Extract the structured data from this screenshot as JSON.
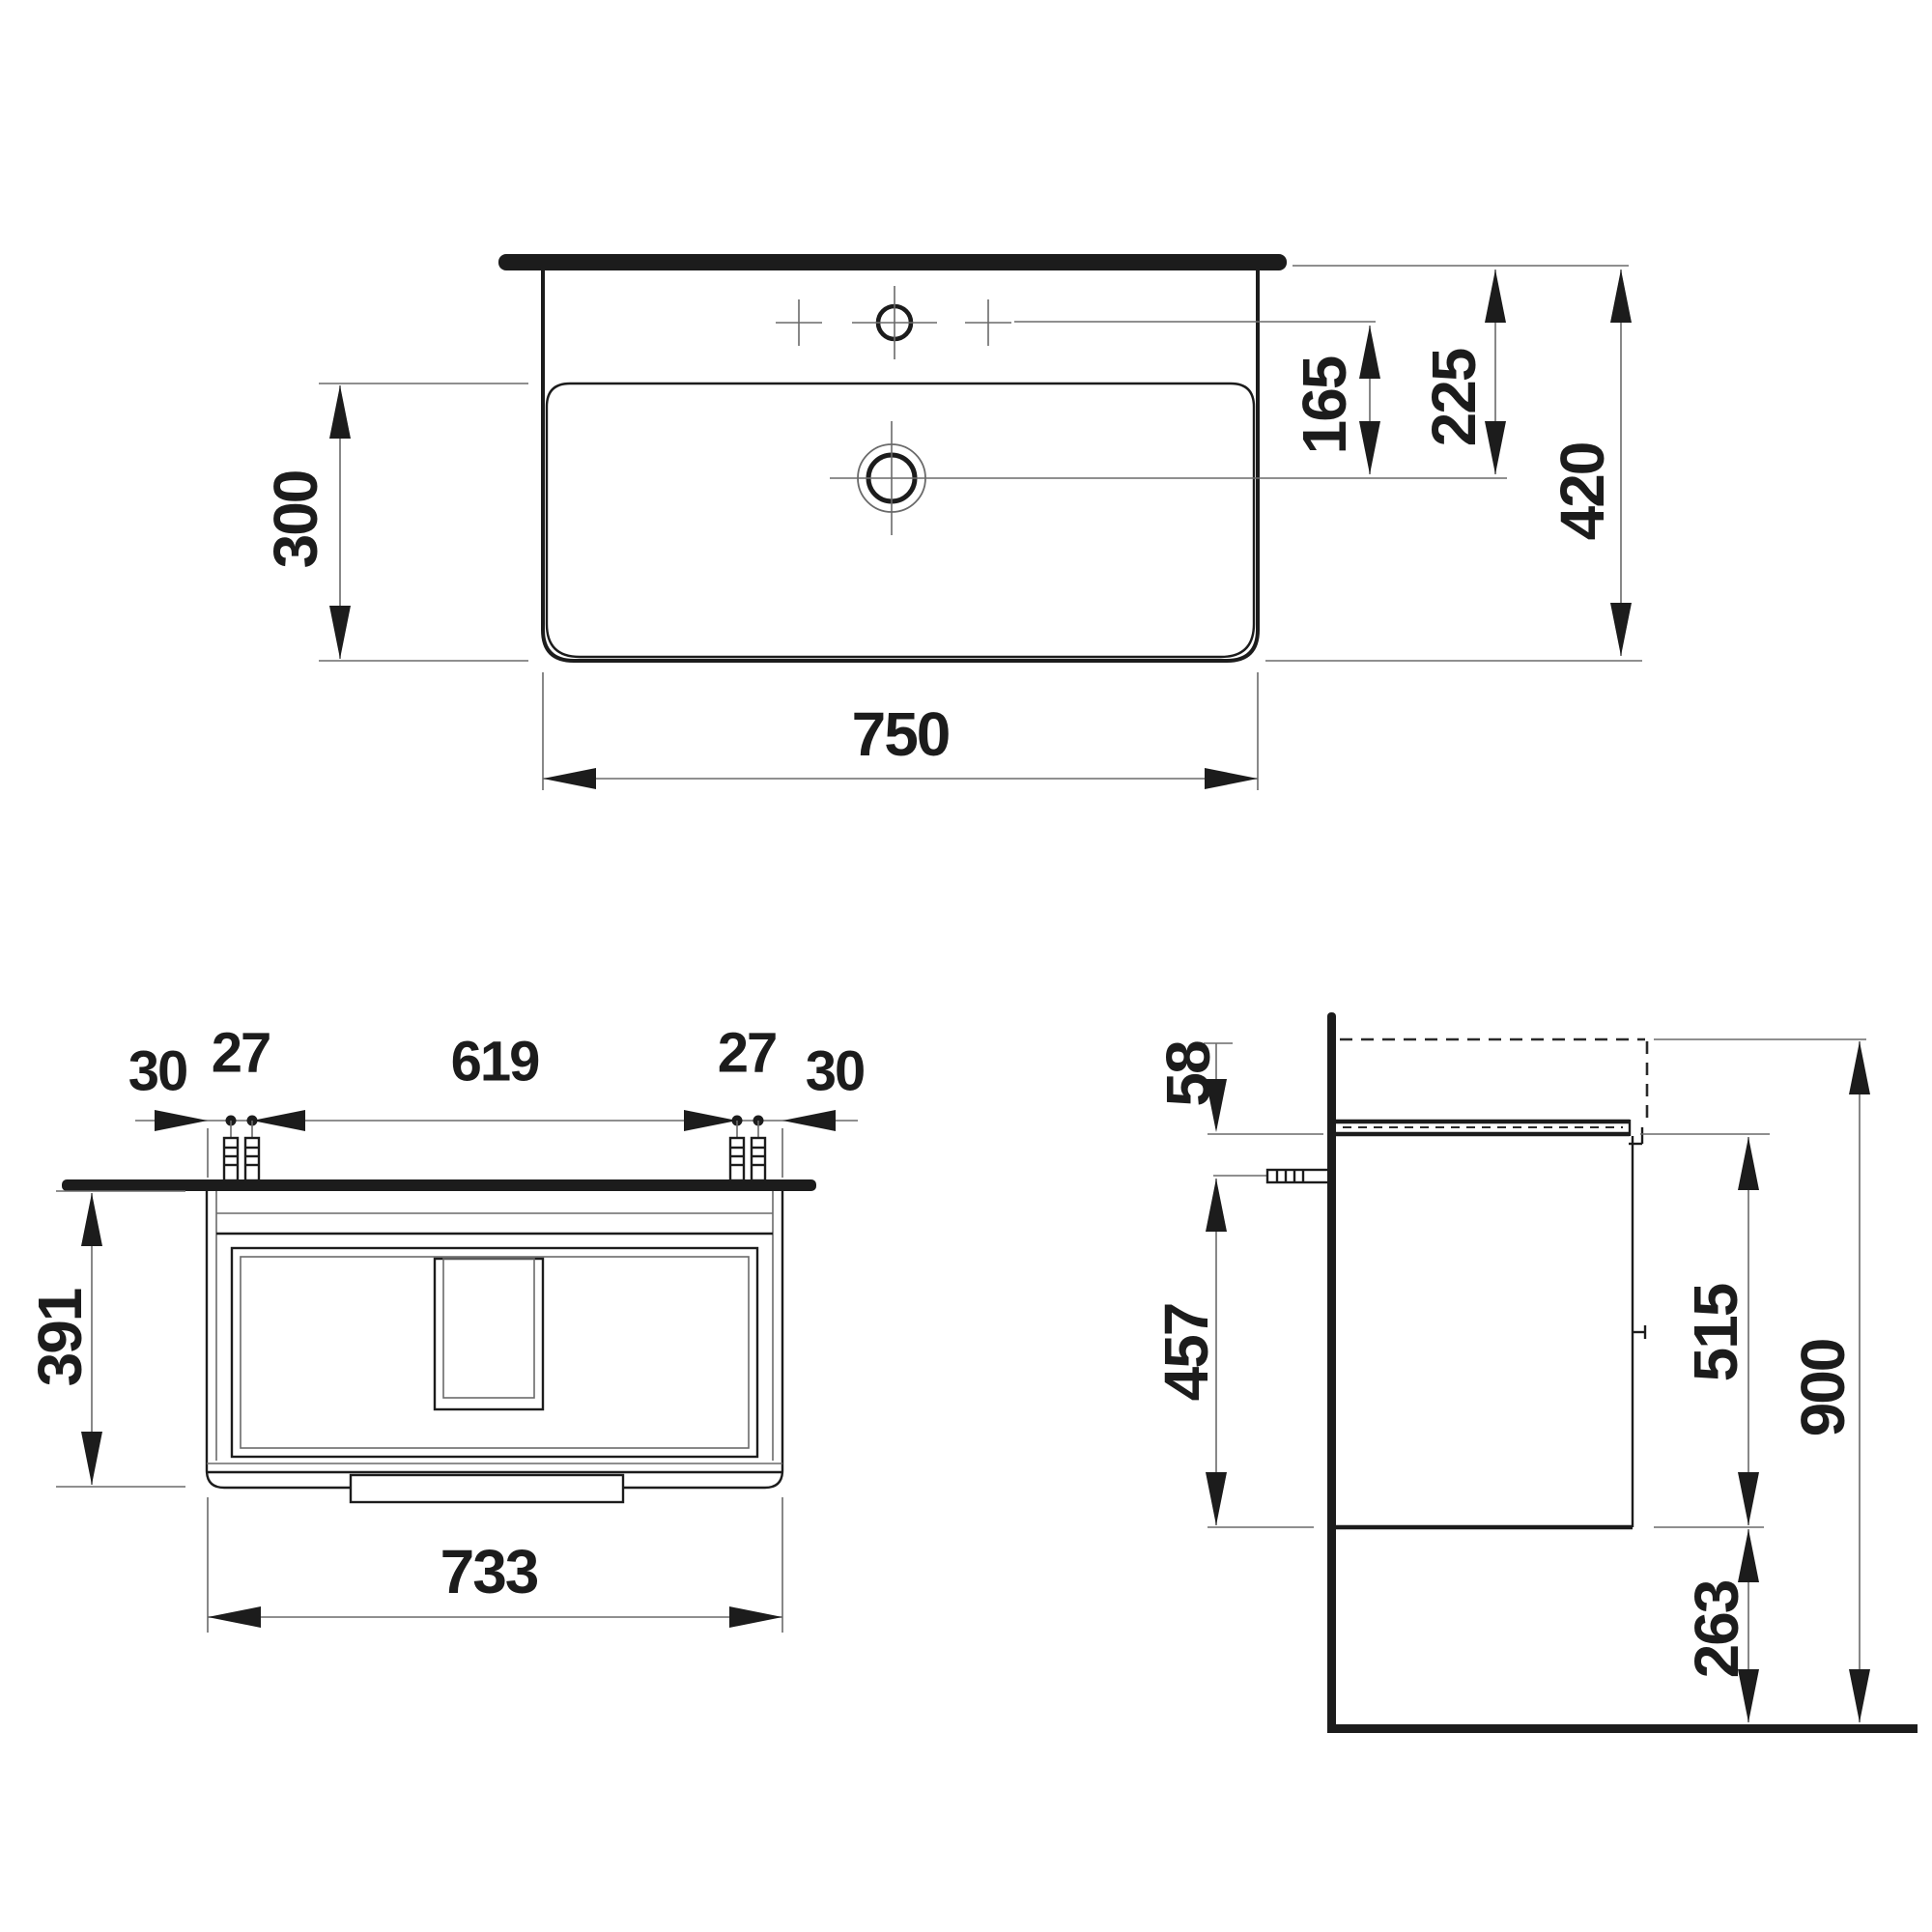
{
  "page": {
    "background": "#ffffff",
    "line_color": "#1c1c1c",
    "thin_line_color": "#6a6a6a"
  },
  "top_view": {
    "width": "750",
    "depth": "420",
    "bowl_depth": "300",
    "faucet_to_drain": "165",
    "rear_to_drain": "225"
  },
  "front_view": {
    "edge_to_dowel_left": "30",
    "dowel_pair_gap_left": "27",
    "dowel_span": "619",
    "dowel_pair_gap_right": "27",
    "edge_to_dowel_right": "30",
    "cabinet_height": "391",
    "cabinet_width": "733"
  },
  "side_view": {
    "top_offset": "58",
    "screw_to_bottom": "457",
    "cabinet_height": "515",
    "floor_clearance": "263",
    "total_height": "900"
  }
}
